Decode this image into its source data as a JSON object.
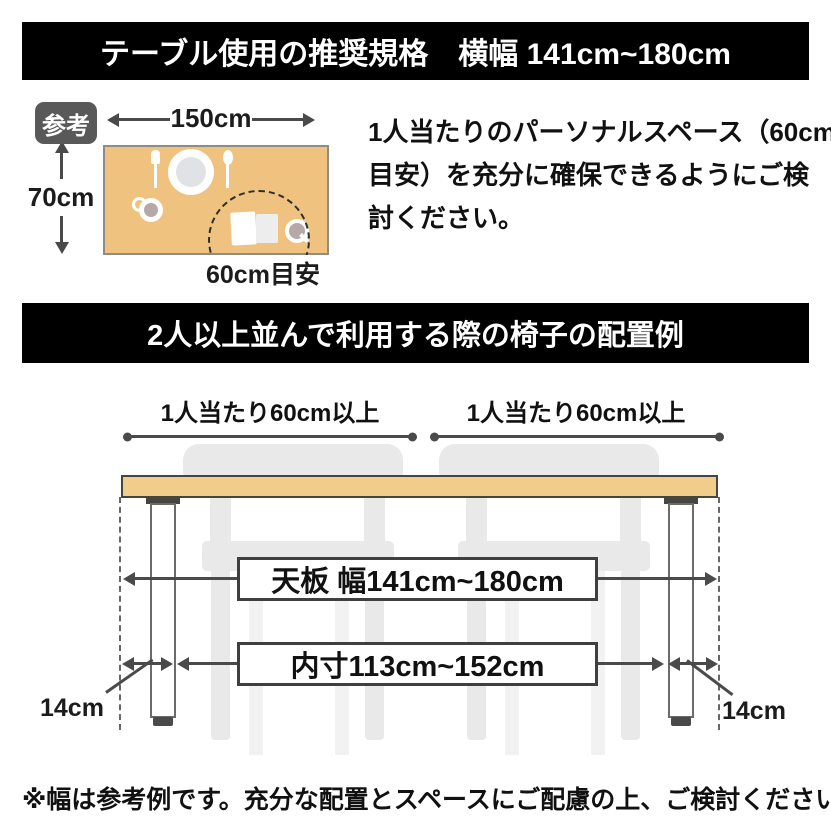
{
  "colors": {
    "header_bg": "#000000",
    "header_text": "#ffffff",
    "badge_bg": "#595959",
    "tabletop_top_view": "#efc27f",
    "tabletop_side_view": "#f2cc8a",
    "outline_dark": "#46453f",
    "dimension_gray": "#4a4a4a",
    "chair_gray": "#e9e9e9",
    "chair_gray_light": "#f2f2f2"
  },
  "section1": {
    "header": "テーブル使用の推奨規格　横幅 141cm~180cm",
    "badge": "参考",
    "table_width_label": "150cm",
    "table_depth_label": "70cm",
    "personal_space_label": "60cm目安",
    "description_lines": [
      "1人当たりのパーソナルスペース（60cm",
      "目安）を充分に確保できるようにご検",
      "討ください。"
    ],
    "icons": [
      "fork-icon",
      "plate-icon",
      "spoon-icon",
      "cup-icon",
      "book-icon",
      "magnifier-icon"
    ]
  },
  "section2": {
    "header": "2人以上並んで利用する際の椅子の配置例",
    "per_person_label_left": "1人当たり60cm以上",
    "per_person_label_right": "1人当たり60cm以上",
    "tabletop_width_label": "天板 幅141cm~180cm",
    "inner_width_label": "内寸113cm~152cm",
    "leg_offset_label_left": "14cm",
    "leg_offset_label_right": "14cm"
  },
  "footnote": "※幅は参考例です。充分な配置とスペースにご配慮の上、ご検討ください。"
}
